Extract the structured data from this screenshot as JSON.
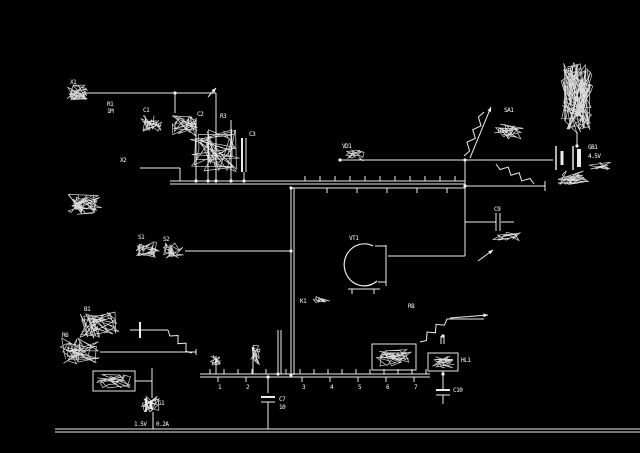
{
  "meta": {
    "title": "scanned circuit schematic, white lines on black",
    "bg": "#000000",
    "fg": "#ffffff",
    "width": 640,
    "height": 453
  },
  "schematic": {
    "wires": [
      [
        85,
        93,
        216,
        93
      ],
      [
        175,
        93,
        175,
        113
      ],
      [
        216,
        93,
        216,
        181
      ],
      [
        140,
        168,
        180,
        168
      ],
      [
        180,
        168,
        180,
        181
      ],
      [
        196,
        118,
        196,
        181
      ],
      [
        208,
        135,
        208,
        181
      ],
      [
        231,
        120,
        231,
        181
      ],
      [
        242,
        138,
        242,
        172,
        2
      ],
      [
        246,
        138,
        246,
        172,
        1
      ],
      [
        244,
        172,
        244,
        181,
        1
      ],
      [
        170,
        181,
        465,
        181
      ],
      [
        170,
        184,
        465,
        184
      ],
      [
        291,
        188,
        465,
        188
      ],
      [
        291,
        188,
        291,
        375
      ],
      [
        294,
        188,
        294,
        375
      ],
      [
        185,
        251,
        291,
        251
      ],
      [
        465,
        160,
        465,
        256
      ],
      [
        340,
        160,
        553,
        160
      ],
      [
        465,
        186,
        545,
        186
      ],
      [
        545,
        181,
        545,
        191
      ],
      [
        465,
        222,
        496,
        222
      ],
      [
        501,
        222,
        514,
        222
      ],
      [
        496,
        213,
        496,
        231
      ],
      [
        500,
        213,
        500,
        231
      ],
      [
        388,
        256,
        465,
        256
      ],
      [
        386,
        245,
        386,
        286
      ],
      [
        577,
        132,
        577,
        146
      ],
      [
        556,
        146,
        556,
        170,
        1.5
      ],
      [
        562,
        151,
        562,
        165,
        3
      ],
      [
        573,
        146,
        573,
        170,
        1.5
      ],
      [
        579,
        149,
        579,
        167,
        4
      ],
      [
        558,
        183,
        578,
        183
      ],
      [
        378,
        282,
        386,
        282
      ],
      [
        375,
        246,
        386,
        246
      ],
      [
        348,
        289,
        380,
        289
      ],
      [
        352,
        289,
        352,
        294
      ],
      [
        374,
        289,
        374,
        294
      ],
      [
        200,
        374,
        430,
        374
      ],
      [
        200,
        377,
        430,
        377
      ],
      [
        268,
        377,
        268,
        393
      ],
      [
        268,
        419,
        268,
        429
      ],
      [
        261,
        397,
        275,
        397,
        2
      ],
      [
        261,
        402,
        275,
        402,
        1
      ],
      [
        268,
        402,
        268,
        419
      ],
      [
        278,
        330,
        278,
        374
      ],
      [
        281,
        330,
        281,
        374
      ],
      [
        253,
        347,
        253,
        374
      ],
      [
        216,
        356,
        216,
        374
      ],
      [
        441,
        336,
        441,
        344
      ],
      [
        444,
        336,
        444,
        344
      ],
      [
        443,
        371,
        443,
        390
      ],
      [
        436,
        390,
        450,
        390,
        2
      ],
      [
        436,
        395,
        450,
        395,
        1
      ],
      [
        443,
        395,
        443,
        404
      ],
      [
        447,
        319,
        484,
        319
      ],
      [
        130,
        330,
        168,
        330
      ],
      [
        140,
        322,
        140,
        338,
        2
      ],
      [
        100,
        352,
        196,
        352
      ],
      [
        196,
        349,
        196,
        355
      ],
      [
        152,
        368,
        152,
        398
      ],
      [
        135,
        381,
        152,
        381
      ],
      [
        146,
        398,
        146,
        412,
        1.5
      ],
      [
        151,
        401,
        151,
        409,
        3
      ],
      [
        153,
        412,
        153,
        429
      ],
      [
        55,
        429,
        640,
        429
      ],
      [
        55,
        432,
        640,
        432
      ],
      [
        210,
        369,
        210,
        374
      ],
      [
        224,
        369,
        224,
        374
      ],
      [
        238,
        369,
        238,
        374
      ],
      [
        252,
        369,
        252,
        374
      ],
      [
        266,
        369,
        266,
        374
      ],
      [
        286,
        369,
        286,
        374
      ],
      [
        300,
        369,
        300,
        374
      ],
      [
        314,
        369,
        314,
        374
      ],
      [
        328,
        369,
        328,
        374
      ],
      [
        342,
        369,
        342,
        374
      ],
      [
        356,
        369,
        356,
        374
      ],
      [
        370,
        369,
        370,
        374
      ],
      [
        384,
        369,
        384,
        374
      ],
      [
        398,
        369,
        398,
        374
      ],
      [
        412,
        369,
        412,
        374
      ],
      [
        426,
        369,
        426,
        374
      ],
      [
        218,
        377,
        218,
        382
      ],
      [
        246,
        377,
        246,
        382
      ],
      [
        302,
        377,
        302,
        382
      ],
      [
        330,
        377,
        330,
        382
      ],
      [
        358,
        377,
        358,
        382
      ],
      [
        386,
        377,
        386,
        382
      ],
      [
        414,
        377,
        414,
        382
      ],
      [
        305,
        176,
        305,
        181
      ],
      [
        320,
        176,
        320,
        181
      ],
      [
        335,
        176,
        335,
        181
      ],
      [
        350,
        176,
        350,
        181
      ],
      [
        365,
        176,
        365,
        181
      ],
      [
        380,
        176,
        380,
        181
      ],
      [
        395,
        176,
        395,
        181
      ],
      [
        410,
        176,
        410,
        181
      ],
      [
        425,
        176,
        425,
        181
      ],
      [
        440,
        176,
        440,
        181
      ],
      [
        455,
        176,
        455,
        181
      ],
      [
        327,
        188,
        327,
        193
      ],
      [
        357,
        188,
        357,
        193
      ],
      [
        387,
        188,
        387,
        193
      ],
      [
        417,
        188,
        417,
        193
      ],
      [
        447,
        188,
        447,
        193
      ]
    ],
    "zigzags": [
      {
        "x1": 464,
        "y1": 156,
        "x2": 484,
        "y2": 112,
        "n": 6,
        "amp": 3
      },
      {
        "x1": 496,
        "y1": 164,
        "x2": 534,
        "y2": 184,
        "n": 6,
        "amp": 3
      },
      {
        "x1": 420,
        "y1": 342,
        "x2": 447,
        "y2": 319,
        "n": 5,
        "amp": 3
      },
      {
        "x1": 168,
        "y1": 330,
        "x2": 192,
        "y2": 353,
        "n": 5,
        "amp": 3
      }
    ],
    "arrows": [
      {
        "x1": 470,
        "y1": 158,
        "x2": 491,
        "y2": 107
      },
      {
        "x1": 450,
        "y1": 318,
        "x2": 488,
        "y2": 315
      },
      {
        "x1": 208,
        "y1": 97,
        "x2": 216,
        "y2": 88
      },
      {
        "x1": 478,
        "y1": 261,
        "x2": 493,
        "y2": 250
      }
    ],
    "paths": [
      {
        "d": "M373,246 A20,21 0 1 0 377,281",
        "w": 1.2
      }
    ],
    "boxes": [
      {
        "x": 428,
        "y": 353,
        "w": 30,
        "h": 18
      },
      {
        "x": 372,
        "y": 344,
        "w": 44,
        "h": 26
      },
      {
        "x": 93,
        "y": 371,
        "w": 42,
        "h": 20
      }
    ],
    "scribbles": [
      {
        "x": 66,
        "y": 85,
        "w": 22,
        "h": 16,
        "n": 40,
        "seed": 3
      },
      {
        "x": 140,
        "y": 114,
        "w": 22,
        "h": 18,
        "n": 34,
        "seed": 5
      },
      {
        "x": 172,
        "y": 114,
        "w": 26,
        "h": 22,
        "n": 40,
        "seed": 7
      },
      {
        "x": 190,
        "y": 128,
        "w": 50,
        "h": 44,
        "n": 52,
        "seed": 9
      },
      {
        "x": 68,
        "y": 193,
        "w": 34,
        "h": 22,
        "n": 46,
        "seed": 11
      },
      {
        "x": 136,
        "y": 240,
        "w": 24,
        "h": 18,
        "n": 36,
        "seed": 13
      },
      {
        "x": 162,
        "y": 242,
        "w": 22,
        "h": 16,
        "n": 32,
        "seed": 15
      },
      {
        "x": 561,
        "y": 62,
        "w": 32,
        "h": 72,
        "n": 120,
        "seed": 17
      },
      {
        "x": 494,
        "y": 124,
        "w": 30,
        "h": 16,
        "n": 28,
        "seed": 19
      },
      {
        "x": 558,
        "y": 170,
        "w": 34,
        "h": 16,
        "n": 32,
        "seed": 21
      },
      {
        "x": 376,
        "y": 348,
        "w": 36,
        "h": 18,
        "n": 40,
        "seed": 23
      },
      {
        "x": 431,
        "y": 356,
        "w": 24,
        "h": 12,
        "n": 24,
        "seed": 25
      },
      {
        "x": 80,
        "y": 312,
        "w": 44,
        "h": 28,
        "n": 50,
        "seed": 27
      },
      {
        "x": 60,
        "y": 338,
        "w": 40,
        "h": 26,
        "n": 46,
        "seed": 29
      },
      {
        "x": 96,
        "y": 374,
        "w": 36,
        "h": 14,
        "n": 30,
        "seed": 31
      },
      {
        "x": 140,
        "y": 396,
        "w": 20,
        "h": 16,
        "n": 24,
        "seed": 33
      },
      {
        "x": 344,
        "y": 150,
        "w": 22,
        "h": 11,
        "n": 22,
        "seed": 35
      },
      {
        "x": 492,
        "y": 232,
        "w": 30,
        "h": 9,
        "n": 20,
        "seed": 37
      },
      {
        "x": 210,
        "y": 355,
        "w": 12,
        "h": 12,
        "n": 16,
        "seed": 39
      },
      {
        "x": 248,
        "y": 345,
        "w": 12,
        "h": 20,
        "n": 20,
        "seed": 41
      },
      {
        "x": 312,
        "y": 295,
        "w": 18,
        "h": 8,
        "n": 14,
        "seed": 43
      },
      {
        "x": 588,
        "y": 162,
        "w": 24,
        "h": 8,
        "n": 14,
        "seed": 45
      }
    ],
    "dots": [
      [
        175,
        93
      ],
      [
        216,
        181
      ],
      [
        244,
        181
      ],
      [
        196,
        181
      ],
      [
        208,
        181
      ],
      [
        231,
        181
      ],
      [
        291,
        251
      ],
      [
        291,
        188
      ],
      [
        340,
        160
      ],
      [
        465,
        160
      ],
      [
        465,
        186
      ],
      [
        268,
        377
      ],
      [
        443,
        374
      ],
      [
        278,
        374
      ],
      [
        577,
        146
      ],
      [
        443,
        336
      ],
      [
        291,
        375
      ]
    ],
    "labels": [
      {
        "t": "X1",
        "x": 70,
        "y": 84
      },
      {
        "t": "R1",
        "x": 107,
        "y": 106
      },
      {
        "t": "1M",
        "x": 107,
        "y": 113
      },
      {
        "t": "C1",
        "x": 143,
        "y": 112
      },
      {
        "t": "C2",
        "x": 197,
        "y": 116
      },
      {
        "t": "R3",
        "x": 220,
        "y": 118
      },
      {
        "t": "C3",
        "x": 249,
        "y": 136
      },
      {
        "t": "X2",
        "x": 120,
        "y": 162
      },
      {
        "t": "S1",
        "x": 138,
        "y": 239
      },
      {
        "t": "S2",
        "x": 163,
        "y": 241
      },
      {
        "t": "K1",
        "x": 300,
        "y": 303
      },
      {
        "t": "VT1",
        "x": 349,
        "y": 240
      },
      {
        "t": "VD1",
        "x": 342,
        "y": 148
      },
      {
        "t": "C9",
        "x": 494,
        "y": 211
      },
      {
        "t": "SA1",
        "x": 504,
        "y": 112
      },
      {
        "t": "R10",
        "x": 498,
        "y": 133
      },
      {
        "t": "GB1",
        "x": 588,
        "y": 149
      },
      {
        "t": "4.5V",
        "x": 588,
        "y": 158
      },
      {
        "t": "R8",
        "x": 408,
        "y": 308
      },
      {
        "t": "HL1",
        "x": 461,
        "y": 362
      },
      {
        "t": "C10",
        "x": 453,
        "y": 392
      },
      {
        "t": "C7",
        "x": 279,
        "y": 401
      },
      {
        "t": "10",
        "x": 279,
        "y": 409
      },
      {
        "t": "B1",
        "x": 84,
        "y": 311
      },
      {
        "t": "R6",
        "x": 62,
        "y": 337
      },
      {
        "t": "G1",
        "x": 158,
        "y": 405
      },
      {
        "t": "1.5V",
        "x": 134,
        "y": 426
      },
      {
        "t": "0.2A",
        "x": 156,
        "y": 426
      },
      {
        "t": "1",
        "x": 218,
        "y": 389
      },
      {
        "t": "2",
        "x": 246,
        "y": 389
      },
      {
        "t": "3",
        "x": 302,
        "y": 389
      },
      {
        "t": "4",
        "x": 330,
        "y": 389
      },
      {
        "t": "5",
        "x": 358,
        "y": 389
      },
      {
        "t": "6",
        "x": 386,
        "y": 389
      },
      {
        "t": "7",
        "x": 414,
        "y": 389
      }
    ]
  }
}
